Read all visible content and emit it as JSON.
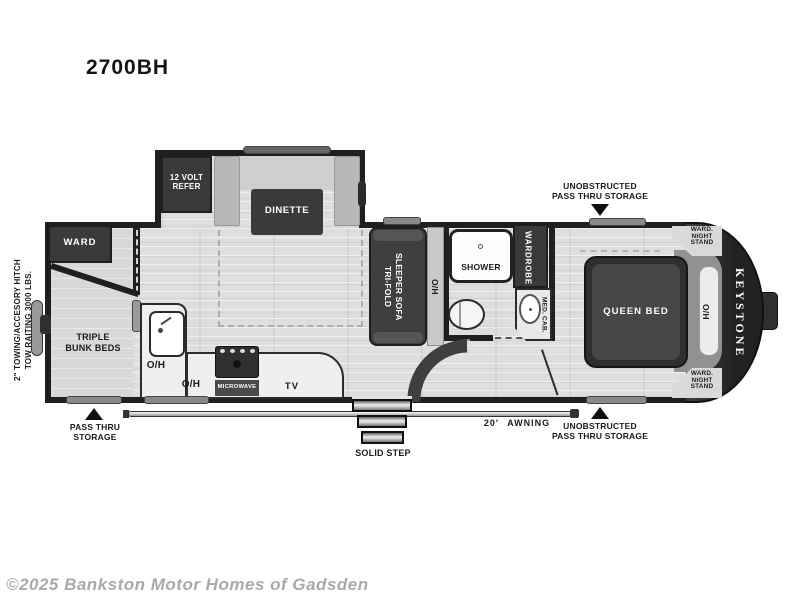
{
  "title": "2700BH",
  "brand": "KEYSTONE",
  "copyright": "©2025 Bankston Motor Homes of Gadsden",
  "hitch_note": "2\" TOWING/ACCESORY HITCH\nTOW RAITING 3000 LBS.",
  "exterior_labels": {
    "unobstructed_pass_thru": "UNOBSTRUCTED\nPASS THRU STORAGE",
    "pass_thru": "PASS THRU\nSTORAGE",
    "awning": "20' AWNING",
    "solid_step": "SOLID STEP"
  },
  "interior_labels": {
    "ward": "WARD",
    "triple_bunk_beds": "TRIPLE\nBUNK BEDS",
    "refer": "12 VOLT\nREFER",
    "dinette": "DINETTE",
    "sofa": "TRI-FOLD\nSLEEPER SOFA",
    "oh": "O/H",
    "shower": "SHOWER",
    "wardrobe": "WARDROBE",
    "med_cab": "MED. CAB.",
    "queen_bed": "QUEEN BED",
    "ward_night_stand": "WARD.\nNIGHT\nSTAND",
    "microwave": "MICROWAVE",
    "tv": "TV"
  },
  "colors": {
    "wall": "#1f1f1f",
    "furniture_dark": "#3a3a3a",
    "floor": "#dedede",
    "label_text": "#1b1b1b",
    "copyright_gray": "#a9a9a9"
  }
}
